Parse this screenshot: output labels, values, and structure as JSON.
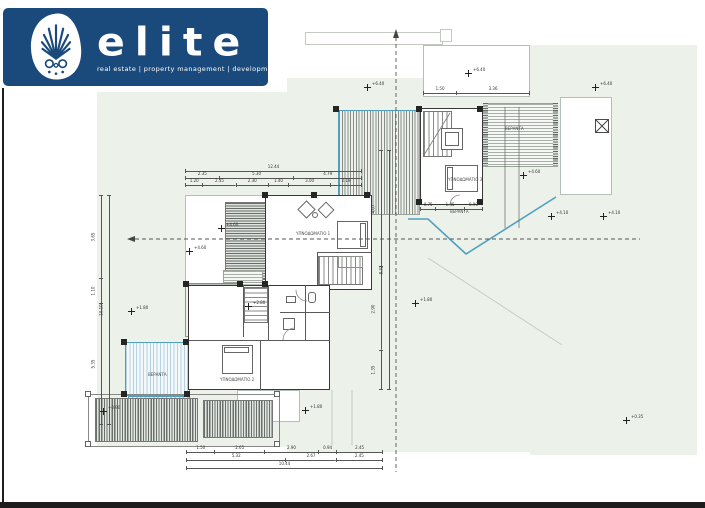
{
  "window": {
    "width": 705,
    "height": 508
  },
  "logo": {
    "brand": "elite",
    "tagline": "real estate | property management | development",
    "icon": "anthemion-palmette-icon",
    "bg_color": "#1a4a7c"
  },
  "plan": {
    "type": "architectural-floor-plan",
    "labels": [
      {
        "text": "ΥΠΝΟΔΩΜΑΤΙΟ 1"
      },
      {
        "text": "ΥΠΝΟΔΩΜΑΤΙΟ 2"
      },
      {
        "text": "ΥΠΝΟΔΩΜΑΤΙΟ 3"
      },
      {
        "text": "ΒΕΡΑΝΤΑ"
      },
      {
        "text": "ΒΕΡΑΝΤΑ"
      },
      {
        "text": "ΒΕΡΑΝΤΑ"
      }
    ],
    "markers": [
      {
        "x": 367,
        "y": 87,
        "label": "+6.40"
      },
      {
        "x": 468,
        "y": 73,
        "label": "+6.40"
      },
      {
        "x": 595,
        "y": 87,
        "label": "+6.40"
      },
      {
        "x": 523,
        "y": 175,
        "label": "+4.60"
      },
      {
        "x": 221,
        "y": 228,
        "label": "+4.60"
      },
      {
        "x": 551,
        "y": 216,
        "label": "+4.10"
      },
      {
        "x": 603,
        "y": 216,
        "label": "+4.10"
      },
      {
        "x": 189,
        "y": 251,
        "label": "+4.60"
      },
      {
        "x": 131,
        "y": 311,
        "label": "+1.80"
      },
      {
        "x": 248,
        "y": 306,
        "label": "+2.80"
      },
      {
        "x": 415,
        "y": 303,
        "label": "+1.80"
      },
      {
        "x": 305,
        "y": 410,
        "label": "+1.80"
      },
      {
        "x": 103,
        "y": 411,
        "label": "+0.90"
      },
      {
        "x": 626,
        "y": 420,
        "label": "+0.35"
      }
    ],
    "dims": {
      "bottom": [
        [
          "1.50",
          "2.65",
          "2.90",
          "0.94",
          "2.45"
        ],
        [
          "5.32",
          "2.67",
          "2.45"
        ],
        [
          "10.44"
        ]
      ],
      "top": [
        [
          "1.20",
          "2.35",
          "2.30",
          "1.40",
          "3.00",
          "2.19"
        ],
        [
          "2.35",
          "5.30",
          "4.79"
        ],
        [
          "12.44"
        ]
      ],
      "unit1_top": [
        [
          "1.50",
          "3.36"
        ]
      ],
      "unit1_bottom": [
        [
          "0.75",
          "1.45",
          "0.90"
        ]
      ],
      "left": [
        [
          "3.65",
          "1.10",
          "5.35"
        ],
        [
          "10.10"
        ]
      ],
      "right": [
        [
          "4.07",
          "2.90",
          "1.35"
        ],
        [
          "8.32"
        ]
      ]
    },
    "colors": {
      "site_tint": "#ecf1ea",
      "accent_cyan": "#4fa0c0",
      "wall": "#333333",
      "hatch_dark": "#6a716a",
      "frame": "#1d1d1d"
    }
  }
}
